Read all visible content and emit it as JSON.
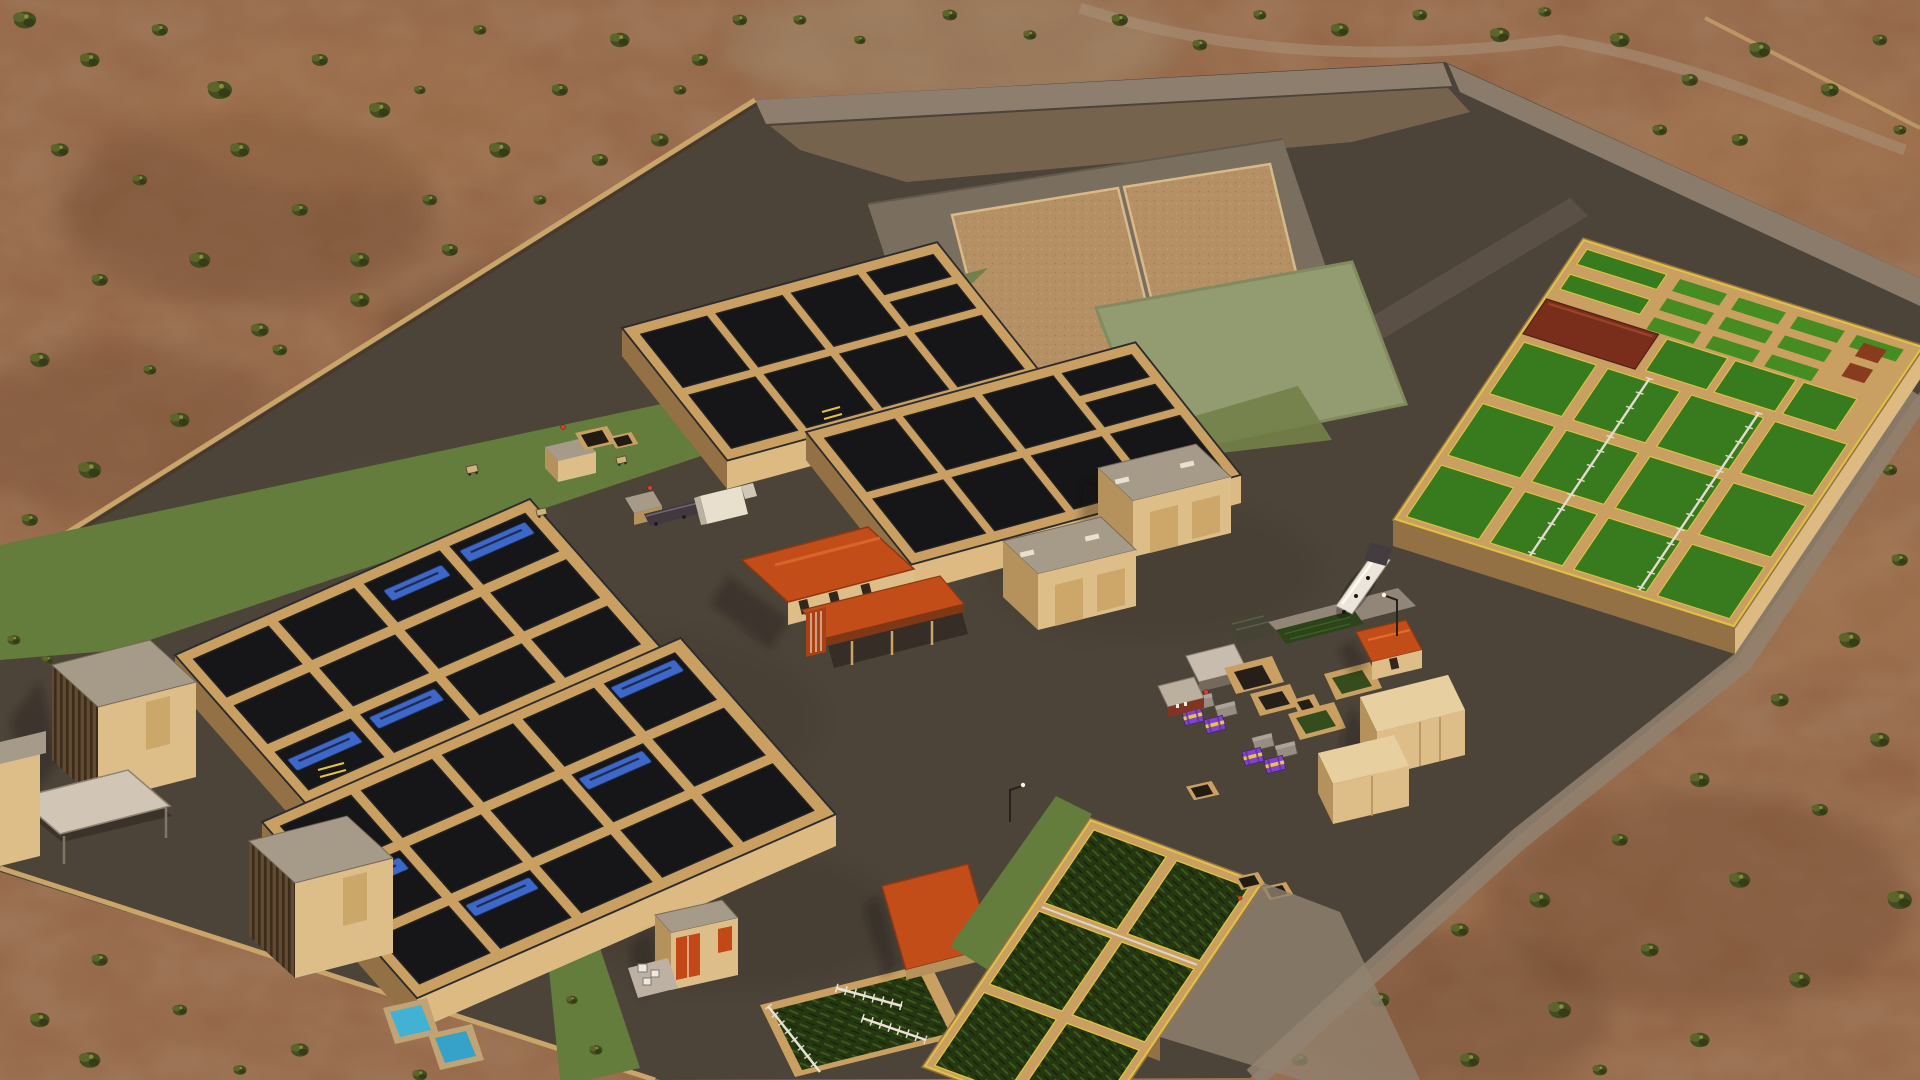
{
  "scene": {
    "title": "Wastewater treatment plant — aerial 3D simulation view",
    "environment": "arid desert scrubland with scattered trees, warm low-angle light",
    "camera": "high-angle tilted aerial view",
    "components": [
      {
        "id": "desert-terrain",
        "label": "Desert scrub terrain with trees"
      },
      {
        "id": "plant-pavement",
        "label": "Dark paved plant yard"
      },
      {
        "id": "perimeter-road",
        "label": "Pale perimeter access roads"
      },
      {
        "id": "sludge-drying-beds",
        "label": "Sludge drying beds (2 sand cells)"
      },
      {
        "id": "lawn-field",
        "label": "Pale green lawn field"
      },
      {
        "id": "clarifier-block-a",
        "label": "Dark clarifier basin block A (2x4)"
      },
      {
        "id": "clarifier-block-b",
        "label": "Dark clarifier basin block B (2x4)"
      },
      {
        "id": "clarifier-block-c",
        "label": "Clarifier block C with blue collector bridges (3x4)"
      },
      {
        "id": "clarifier-block-d",
        "label": "Clarifier block D with blue collector bridges (3x5)"
      },
      {
        "id": "aeration-complex",
        "label": "Aeration basin complex, green water, yellow guardrails, maroon blower building, small cell grid"
      },
      {
        "id": "contact-basin",
        "label": "Green-water contact basin block with yellow guardrails"
      },
      {
        "id": "sbr-basin",
        "label": "Green basin with white truss walkways"
      },
      {
        "id": "admin-building",
        "label": "Administration building, orange hip roof with canopy"
      },
      {
        "id": "storage-buildings",
        "label": "Two tan flat-roof storage buildings"
      },
      {
        "id": "louvered-buildings",
        "label": "Two tall louvered process buildings"
      },
      {
        "id": "garage-canopy",
        "label": "Open garage canopy"
      },
      {
        "id": "warehouses",
        "label": "Tan warehouses at chemical yard"
      },
      {
        "id": "chemical-totes",
        "label": "Purple chemical totes with yellow straps on pallets"
      },
      {
        "id": "tanker-truck",
        "label": "White tanker truck at unloading pad"
      },
      {
        "id": "equipment-pits",
        "label": "Open concrete pits, some with green water"
      },
      {
        "id": "container-shed",
        "label": "Container shed with orange doors"
      },
      {
        "id": "transformer-pad",
        "label": "Electrical transformer pad"
      },
      {
        "id": "clean-water-pools",
        "label": "Two small cyan pools"
      },
      {
        "id": "orange-hut",
        "label": "Orange hip-roof utility hut"
      },
      {
        "id": "orange-shed",
        "label": "Long orange-roof shed"
      },
      {
        "id": "workers",
        "label": "Workers in hi-vis vests"
      },
      {
        "id": "street-lamps",
        "label": "Street lamps"
      }
    ]
  },
  "colors": {
    "desert": "#8a5c40",
    "desertDark": "#6a452f",
    "desertLight": "#a3764f",
    "scrub": "#3d4a1f",
    "pave": "#454039",
    "paveLight": "#57504a",
    "roadPale": "#8d8172",
    "wallTan": "#c7a064",
    "wallTanLight": "#dbbc84",
    "wallTanDark": "#8f6f45",
    "waterDark": "#0c0f15",
    "waterGreen": "#2f7a1d",
    "waterGreenDark": "#1b330f",
    "grass": "#5d7b3c",
    "lawn": "#8e9c72",
    "lawnDark": "#6d7f4a",
    "railYellow": "#e2c63e",
    "blueEquip": "#3566cf",
    "poolCyan": "#39b3da",
    "roofOrange": "#c04a16",
    "roofMaroon": "#73281a",
    "bldgTan": "#dcc08c",
    "bldgTanDark": "#b2915c",
    "roofGray": "#a39a8c",
    "purple": "#7b3fd6",
    "toteYellow": "#e8c83c",
    "white": "#efece4"
  }
}
